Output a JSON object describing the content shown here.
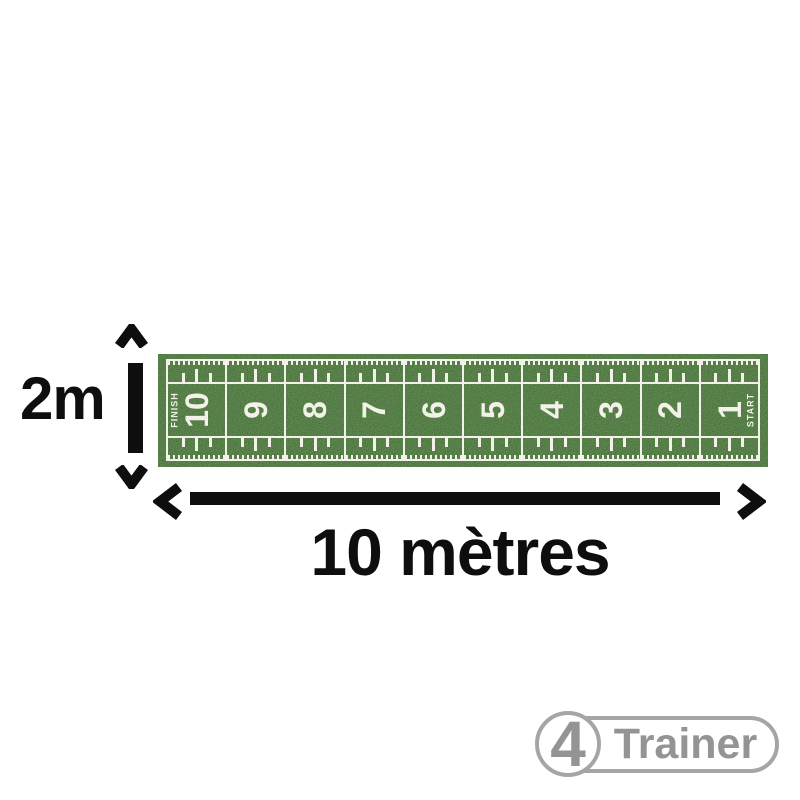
{
  "page": {
    "background": "#ffffff"
  },
  "colors": {
    "ink": "#0e0e0e",
    "mat_green": "#48743a",
    "mat_line": "#f2f1e9",
    "logo_gray": "#949494",
    "logo_border": "#a5a5a5"
  },
  "diagram": {
    "height_label": "2m",
    "width_label": "10 mètres"
  },
  "mat": {
    "finish_label": "FINISH",
    "start_label": "START",
    "cells": [
      {
        "number": "10",
        "tag": "FINISH",
        "tag_side": "left"
      },
      {
        "number": "9"
      },
      {
        "number": "8"
      },
      {
        "number": "7"
      },
      {
        "number": "6"
      },
      {
        "number": "5"
      },
      {
        "number": "4"
      },
      {
        "number": "3"
      },
      {
        "number": "2"
      },
      {
        "number": "1",
        "tag": "START",
        "tag_side": "right"
      }
    ]
  },
  "logo": {
    "badge_digit": "4",
    "brand": "Trainer"
  }
}
